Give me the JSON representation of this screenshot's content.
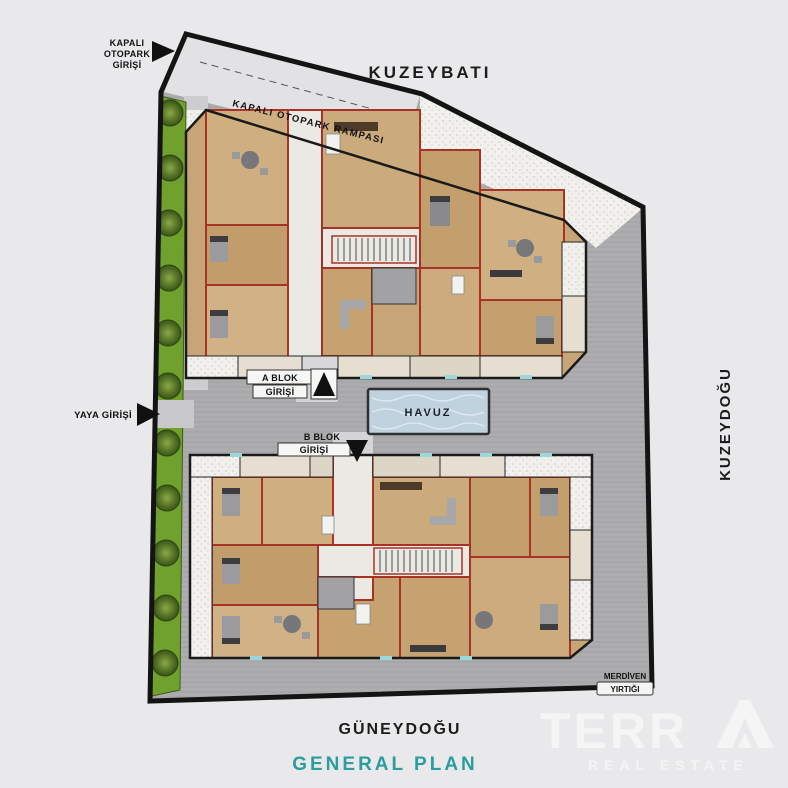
{
  "compass": {
    "northwest": "KUZEYBATI",
    "northeast": "KUZEYDOĞU",
    "southeast": "GÜNEYDOĞU"
  },
  "labels": {
    "parking_entrance": [
      "KAPALI",
      "OTOPARK",
      "GİRİŞİ"
    ],
    "parking_ramp": "KAPALI OTOPARK RAMPASI",
    "pedestrian_entrance": "YAYA GİRİŞİ",
    "block_a_entrance": [
      "A BLOK",
      "GİRİŞİ"
    ],
    "block_b_entrance": [
      "B BLOK",
      "GİRİŞİ"
    ],
    "pool": "HAVUZ",
    "stair_shaft": [
      "MERDİVEN",
      "YIRTIĞI"
    ]
  },
  "footer": {
    "plan_title": "GENERAL PLAN"
  },
  "brand": {
    "name": "TERR",
    "tagline": "REAL ESTATE"
  },
  "colors": {
    "background": "#e9e9eb",
    "boundary": "#141414",
    "road": "#adadaf",
    "ramp": "#e2e2e4",
    "green": "#6fa12c",
    "pool": "#c0d2de",
    "wood": "#c8a577",
    "corridor": "#ebe9e4",
    "wall_red": "#a93226",
    "accent_teal": "#2a9d9f",
    "watermark": "#ffffff"
  }
}
